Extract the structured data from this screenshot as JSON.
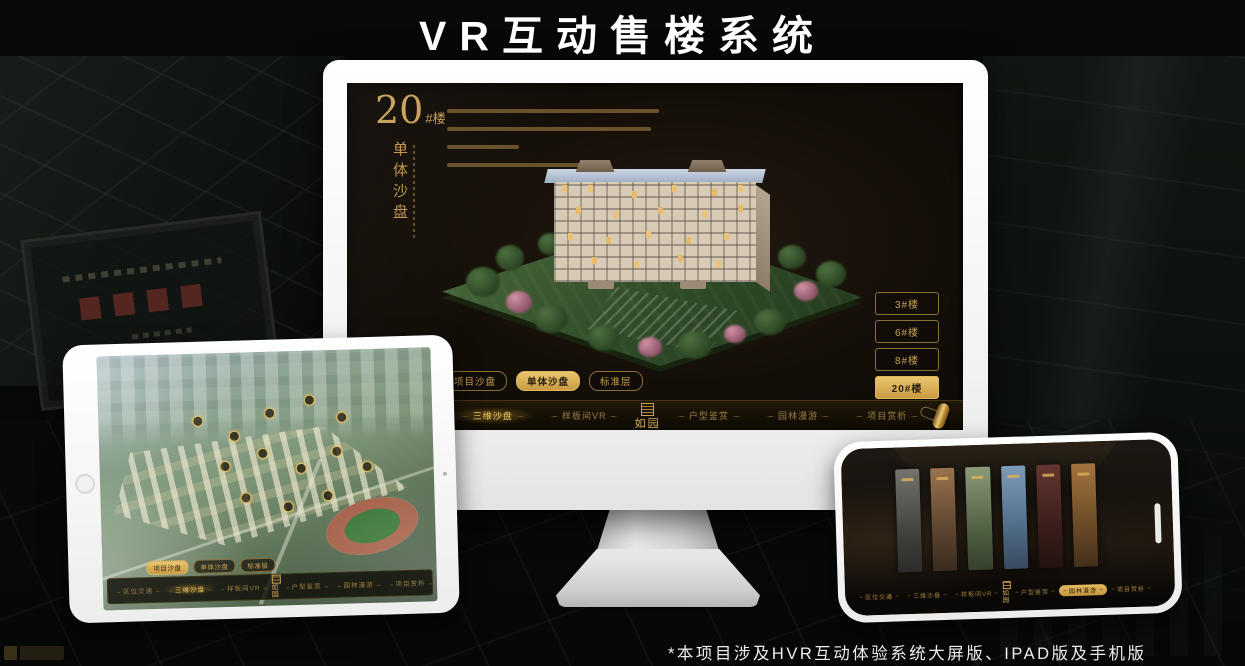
{
  "title": "VR互动售楼系统",
  "footnote": "*本项目涉及HVR互动体验系统大屏版、IPAD版及手机版",
  "brand": {
    "logo": "如园"
  },
  "theme": {
    "accent_gold": "#D9B055",
    "screen_bg": "#140E08",
    "page_bg": "#070908",
    "device_white": "#F5F5F5"
  },
  "shared": {
    "tabs": [
      "项目沙盘",
      "单体沙盘",
      "标准层"
    ],
    "nav_items": [
      "区位交通",
      "三维沙盘",
      "样板间VR",
      "户型鉴赏",
      "园林漫游",
      "项目赏析"
    ]
  },
  "monitor": {
    "unit_title": {
      "number": "20",
      "suffix": "#楼",
      "subtitle": "单体沙盘"
    },
    "building_buttons": [
      "3#楼",
      "6#楼",
      "8#楼",
      "20#楼"
    ]
  }
}
